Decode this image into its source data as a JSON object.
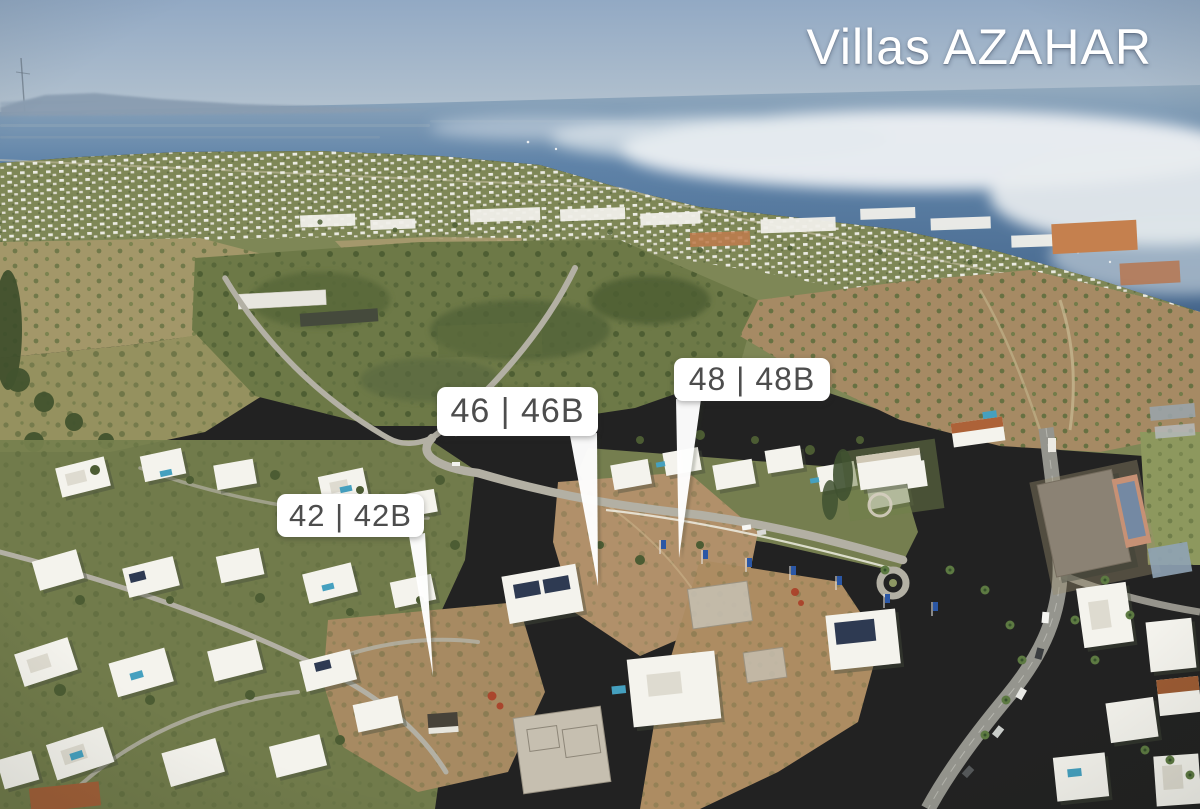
{
  "title": "Villas AZAHAR",
  "photo_alt": "Aerial drone photo of a coastal villa development with the sea and a fog bank on the horizon",
  "plot_labels": [
    {
      "id": "42",
      "text": "42 | 42B"
    },
    {
      "id": "46",
      "text": "46 | 46B"
    },
    {
      "id": "48",
      "text": "48 | 48B"
    }
  ],
  "palette": {
    "title_color": "#ffffff",
    "label_background": "#ffffff",
    "label_text": "#4d4d4d",
    "sky_top": "#92a9c4",
    "sky_horizon": "#c6cfd7",
    "sea_haze": "#93aabe",
    "sea_deep": "#44658b",
    "fog_white": "#edf0f3",
    "scrub_green": "#6d7947",
    "tree_green": "#4c5c33",
    "field_tan": "#a39769",
    "dirt_plot": "#b1906a",
    "villa_white": "#f4f3ed",
    "road_gray": "#b3b0a4",
    "pool_blue": "#45a0bf",
    "flag_blue": "#2b57a5",
    "terracotta": "#a05f38"
  }
}
